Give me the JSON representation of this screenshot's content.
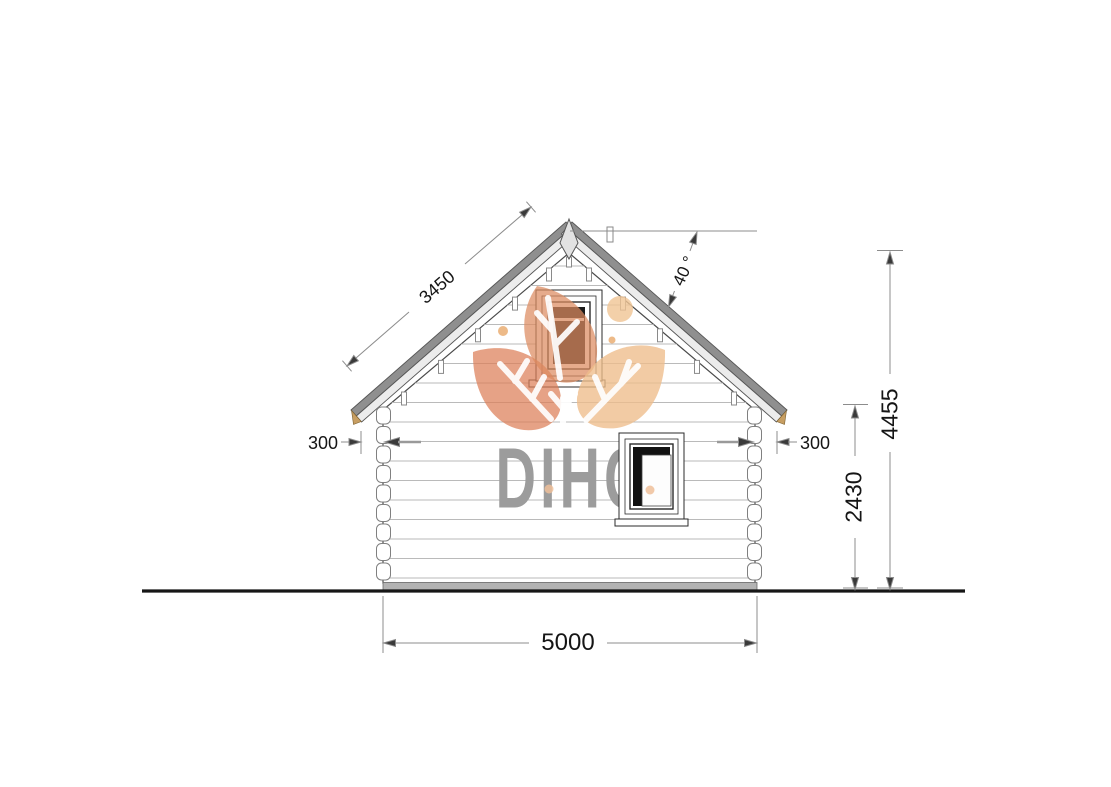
{
  "watermark": {
    "brand": "DIHC"
  },
  "dimensions": {
    "roof_slope_length": "3450",
    "roof_angle": "40 °",
    "overhang_left": "300",
    "overhang_right": "300",
    "total_height": "4455",
    "wall_height": "2430",
    "base_width": "5000"
  },
  "colors": {
    "watermark_text": "#9c9c9c",
    "leaf_dark": "#dc7e57",
    "leaf_mid": "#dc8a60",
    "leaf_light": "#eebc8a",
    "leaf_dot": "#f0c493",
    "roof_dark": "#8f8f8f",
    "roof_light": "#ececec",
    "eave_cut": "#c79e62",
    "siding_line": "#bababa",
    "dimension_line": "#8c8c8c",
    "dimension_text": "#151515",
    "ground_line": "#161616"
  }
}
